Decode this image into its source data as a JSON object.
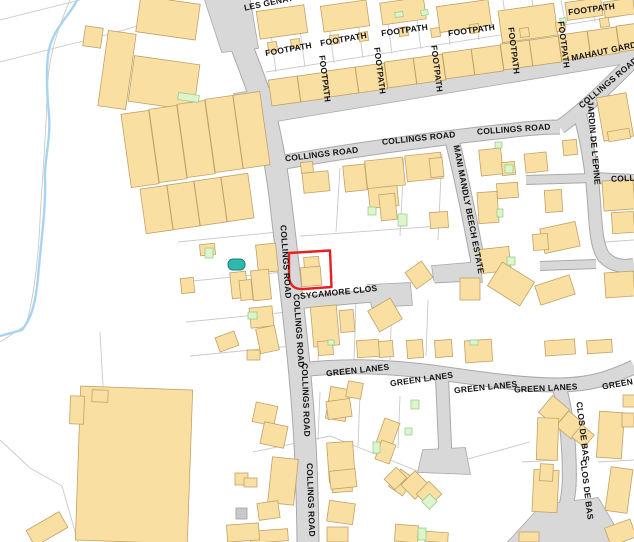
{
  "map": {
    "title": "Street map - Collings Road area",
    "colors": {
      "background": "#ffffff",
      "building_fill": "#FADFA3",
      "building_stroke": "#C0A267",
      "road_fill": "#D8D8D8",
      "road_casing": "#A9A9A9",
      "parcel_line": "#C9C9C9",
      "stream": "#A8D4F2",
      "green_fill": "#DCF5CC",
      "green_stroke": "#8FC985",
      "pool_fill": "#2FB9AE",
      "pool_stroke": "#17807A",
      "plot_outline": "#E62020",
      "label": "#141414",
      "gray_building_fill": "#C9C9C9",
      "gray_building_stroke": "#9E9E9E"
    },
    "labels": [
      {
        "t": "FOOTPATH",
        "x": 289,
        "y": 52,
        "r": -10
      },
      {
        "t": "FOOTPATH",
        "x": 344,
        "y": 42,
        "r": -10
      },
      {
        "t": "FOOTPATH",
        "x": 405,
        "y": 33,
        "r": -8
      },
      {
        "t": "FOOTPATH",
        "x": 472,
        "y": 33,
        "r": -8
      },
      {
        "t": "FOOTPATH",
        "x": 592,
        "y": 12,
        "r": -8
      },
      {
        "t": "FOOTPATH",
        "x": 322,
        "y": 79,
        "r": 83
      },
      {
        "t": "FOOTPATH",
        "x": 377,
        "y": 71,
        "r": 83
      },
      {
        "t": "FOOTPATH",
        "x": 434,
        "y": 69,
        "r": 83
      },
      {
        "t": "FOOTPATH",
        "x": 511,
        "y": 51,
        "r": 83
      },
      {
        "t": "FOOTPATH",
        "x": 561,
        "y": 45,
        "r": 83
      },
      {
        "t": "LES GENATS",
        "x": 272,
        "y": 5,
        "r": -12
      },
      {
        "t": "MAHAUT GARDENS",
        "x": 572,
        "y": 61,
        "r": -12,
        "a": "start"
      },
      {
        "t": "COLLINGS ROAD",
        "x": 610,
        "y": 85,
        "r": -40
      },
      {
        "t": "COLLINGS ROAD",
        "x": 322,
        "y": 157,
        "r": -7
      },
      {
        "t": "COLLINGS ROAD",
        "x": 419,
        "y": 141,
        "r": -6
      },
      {
        "t": "COLLINGS ROAD",
        "x": 514,
        "y": 132,
        "r": -4
      },
      {
        "t": "COLLINGS ROAD",
        "x": 648,
        "y": 180,
        "r": -3
      },
      {
        "t": "COLLINGS ROAD",
        "x": 283,
        "y": 262,
        "r": 86
      },
      {
        "t": "COLLINGS ROAD",
        "x": 296,
        "y": 331,
        "r": 86
      },
      {
        "t": "COLLINGS ROAD",
        "x": 303,
        "y": 400,
        "r": 88
      },
      {
        "t": "COLLINGS ROAD",
        "x": 308,
        "y": 500,
        "r": 88
      },
      {
        "t": "JARDIN DE L'EPINE",
        "x": 591,
        "y": 143,
        "r": 85
      },
      {
        "t": "MANI MANDLY BEECH ESTATE",
        "x": 466,
        "y": 210,
        "r": 79
      },
      {
        "t": "SYCAMORE CLOS",
        "x": 339,
        "y": 295,
        "r": -6
      },
      {
        "t": "GREEN LANES",
        "x": 358,
        "y": 373,
        "r": -6
      },
      {
        "t": "GREEN LANES",
        "x": 422,
        "y": 382,
        "r": -8
      },
      {
        "t": "GREEN LANES",
        "x": 486,
        "y": 390,
        "r": -6
      },
      {
        "t": "GREEN LANES",
        "x": 546,
        "y": 391,
        "r": -3
      },
      {
        "t": "GREEN LANES",
        "x": 634,
        "y": 384,
        "r": -10
      },
      {
        "t": "CLOS DE BAS",
        "x": 580,
        "y": 432,
        "r": 83
      },
      {
        "t": "CLOS DE BAS",
        "x": 584,
        "y": 490,
        "r": 83
      }
    ],
    "roads": [
      {
        "name": "collings-road-vertical",
        "d": "M226,0 C238,42 254,74 263,106 C272,140 277,170 281,205 C287,255 293,305 298,355 C303,405 307,455 308,542",
        "w": 21
      },
      {
        "name": "collings-road-horizontal",
        "d": "M274,164 C340,152 430,139 506,131 C530,128 546,127 560,127",
        "w": 13
      },
      {
        "name": "collings-road-diagonal",
        "d": "M560,127 C582,111 604,90 632,62",
        "w": 13
      },
      {
        "name": "jardin-de-lepine",
        "d": "M578,108 C588,142 592,172 594,202 C596,232 597,247 604,257 C613,266 623,267 634,265",
        "w": 12
      },
      {
        "name": "collings-road-east-spur",
        "d": "M594,178 L634,180",
        "w": 10
      },
      {
        "name": "stub-west",
        "d": "M526,180 L594,178",
        "w": 8
      },
      {
        "name": "stub-265",
        "d": "M540,266 L596,264",
        "w": 8
      },
      {
        "name": "mani-mandly-beech-estate",
        "d": "M452,140 C462,180 469,215 476,252 C479,264 478,272 470,274 L434,276",
        "w": 13
      },
      {
        "name": "sycamore-clos",
        "d": "M294,303 L372,296",
        "w": 11
      },
      {
        "name": "green-lanes",
        "d": "M300,370 C345,365 385,366 432,372 C482,379 522,385 558,385 C592,385 612,377 634,367",
        "w": 13
      },
      {
        "name": "green-lanes-branch",
        "d": "M442,378 C443,402 444,424 445,446 L445,460",
        "w": 12
      },
      {
        "name": "clos-de-bas",
        "d": "M560,390 C566,412 568,434 569,458 C570,484 569,498 564,512 C558,528 548,536 538,542",
        "w": 13
      }
    ],
    "road_polygons": [
      {
        "name": "mahaut-gardens-road",
        "pts": "234,94 634,24 634,62 240,127"
      },
      {
        "name": "sycamore-bulb",
        "pts": "368,285 410,283 412,305 372,307"
      },
      {
        "name": "mani-flare",
        "pts": "432,266 480,262 482,282 434,280"
      },
      {
        "name": "branch-flare",
        "pts": "423,450 465,448 470,474 418,472"
      },
      {
        "name": "clos-flare",
        "pts": "542,505 598,498 624,542 508,542"
      },
      {
        "name": "road-top-corner",
        "pts": "205,0 250,0 258,48 222,52"
      }
    ],
    "buildings": [
      [
        138,
        0,
        60,
        36,
        8
      ],
      [
        103,
        32,
        28,
        76,
        8
      ],
      [
        131,
        60,
        66,
        46,
        8
      ],
      [
        84,
        27,
        18,
        20,
        8
      ],
      [
        126,
        112,
        28,
        74,
        -8
      ],
      [
        154,
        107,
        28,
        74,
        -8
      ],
      [
        182,
        102,
        28,
        74,
        -8
      ],
      [
        210,
        97,
        28,
        74,
        -8
      ],
      [
        238,
        93,
        27,
        74,
        -8
      ],
      [
        143,
        187,
        27,
        45,
        -8
      ],
      [
        170,
        183,
        27,
        45,
        -8
      ],
      [
        197,
        179,
        27,
        45,
        -8
      ],
      [
        224,
        175,
        27,
        45,
        -8
      ],
      [
        258,
        8,
        48,
        28,
        -8
      ],
      [
        322,
        3,
        46,
        26,
        -8
      ],
      [
        381,
        0,
        44,
        22,
        -8
      ],
      [
        438,
        3,
        52,
        26,
        -8
      ],
      [
        500,
        7,
        56,
        32,
        -8
      ],
      [
        566,
        0,
        36,
        18,
        -8
      ],
      [
        604,
        0,
        30,
        16,
        -8
      ],
      [
        268,
        42,
        9,
        9,
        -8
      ],
      [
        291,
        39,
        9,
        9,
        -8
      ],
      [
        330,
        35,
        9,
        9,
        -8
      ],
      [
        359,
        32,
        9,
        9,
        -8
      ],
      [
        399,
        27,
        9,
        9,
        -8
      ],
      [
        431,
        28,
        9,
        9,
        -8
      ],
      [
        470,
        24,
        9,
        9,
        -8
      ],
      [
        520,
        28,
        9,
        9,
        -8
      ],
      [
        556,
        22,
        9,
        9,
        -8
      ],
      [
        600,
        18,
        9,
        9,
        -8
      ],
      [
        270,
        78,
        29,
        26,
        -8
      ],
      [
        299,
        74,
        29,
        26,
        -8
      ],
      [
        328,
        69,
        29,
        26,
        -8
      ],
      [
        357,
        65,
        29,
        26,
        -8
      ],
      [
        386,
        60,
        29,
        26,
        -8
      ],
      [
        415,
        56,
        29,
        26,
        -8
      ],
      [
        444,
        51,
        29,
        26,
        -8
      ],
      [
        473,
        47,
        29,
        26,
        -8
      ],
      [
        502,
        42,
        29,
        26,
        -8
      ],
      [
        531,
        38,
        29,
        26,
        -8
      ],
      [
        560,
        33,
        29,
        26,
        -8
      ],
      [
        589,
        29,
        29,
        26,
        -8
      ],
      [
        618,
        24,
        29,
        26,
        -8
      ],
      [
        301,
        162,
        12,
        11,
        -6
      ],
      [
        303,
        172,
        26,
        20,
        -6
      ],
      [
        344,
        165,
        22,
        26,
        -6
      ],
      [
        366,
        159,
        38,
        28,
        -6
      ],
      [
        406,
        154,
        36,
        26,
        -6
      ],
      [
        369,
        187,
        29,
        20,
        -6
      ],
      [
        380,
        194,
        16,
        26,
        -6
      ],
      [
        430,
        158,
        13,
        19,
        -6
      ],
      [
        480,
        149,
        22,
        26,
        -6
      ],
      [
        502,
        162,
        13,
        13,
        -6
      ],
      [
        525,
        153,
        22,
        19,
        -6
      ],
      [
        563,
        140,
        14,
        15,
        -6
      ],
      [
        600,
        95,
        30,
        44,
        -10
      ],
      [
        608,
        130,
        22,
        10,
        -10
      ],
      [
        497,
        183,
        21,
        15,
        -4
      ],
      [
        478,
        192,
        20,
        31,
        -4
      ],
      [
        430,
        212,
        18,
        16,
        -4
      ],
      [
        545,
        190,
        17,
        22,
        -4
      ],
      [
        542,
        225,
        36,
        25,
        -12
      ],
      [
        603,
        180,
        31,
        30,
        -4
      ],
      [
        612,
        212,
        22,
        21,
        -4
      ],
      [
        480,
        248,
        30,
        24,
        -6
      ],
      [
        533,
        234,
        15,
        16,
        -4
      ],
      [
        537,
        280,
        36,
        20,
        -18
      ],
      [
        605,
        272,
        29,
        25,
        -4
      ],
      [
        492,
        270,
        38,
        28,
        32
      ],
      [
        460,
        278,
        20,
        22,
        0
      ],
      [
        304,
        257,
        15,
        11,
        -5
      ],
      [
        301,
        267,
        20,
        19,
        -5
      ],
      [
        257,
        244,
        20,
        28,
        -6
      ],
      [
        200,
        244,
        15,
        11,
        -6
      ],
      [
        181,
        278,
        13,
        15,
        -6
      ],
      [
        231,
        272,
        16,
        26,
        -6
      ],
      [
        252,
        270,
        18,
        30,
        -6
      ],
      [
        240,
        280,
        12,
        20,
        -6
      ],
      [
        250,
        307,
        23,
        20,
        -6
      ],
      [
        258,
        327,
        19,
        25,
        -12
      ],
      [
        312,
        306,
        26,
        40,
        -5
      ],
      [
        340,
        310,
        14,
        22,
        -5
      ],
      [
        372,
        303,
        26,
        24,
        -30
      ],
      [
        409,
        265,
        20,
        20,
        -35
      ],
      [
        318,
        341,
        15,
        14,
        -4
      ],
      [
        357,
        340,
        22,
        17,
        -4
      ],
      [
        379,
        341,
        14,
        16,
        -4
      ],
      [
        407,
        340,
        16,
        18,
        -4
      ],
      [
        435,
        340,
        17,
        17,
        -4
      ],
      [
        465,
        340,
        27,
        22,
        -4
      ],
      [
        545,
        340,
        30,
        15,
        -4
      ],
      [
        587,
        340,
        25,
        13,
        -4
      ],
      [
        328,
        388,
        20,
        32,
        10
      ],
      [
        347,
        382,
        15,
        16,
        10
      ],
      [
        254,
        404,
        22,
        20,
        12
      ],
      [
        262,
        424,
        24,
        22,
        12
      ],
      [
        270,
        458,
        26,
        46,
        6
      ],
      [
        235,
        473,
        13,
        12,
        0
      ],
      [
        258,
        502,
        21,
        17,
        -8
      ],
      [
        250,
        530,
        38,
        12,
        -4
      ],
      [
        327,
        400,
        24,
        18,
        -8
      ],
      [
        328,
        442,
        26,
        40,
        -4
      ],
      [
        332,
        480,
        20,
        12,
        -4
      ],
      [
        380,
        420,
        16,
        26,
        20
      ],
      [
        378,
        442,
        15,
        20,
        20
      ],
      [
        393,
        472,
        17,
        21,
        35
      ],
      [
        330,
        470,
        26,
        18,
        -6
      ],
      [
        328,
        502,
        26,
        21,
        8
      ],
      [
        327,
        527,
        21,
        15,
        0
      ],
      [
        395,
        525,
        23,
        17,
        4
      ],
      [
        425,
        532,
        23,
        10,
        4
      ],
      [
        388,
        470,
        15,
        17,
        45
      ],
      [
        405,
        475,
        20,
        20,
        45
      ],
      [
        420,
        485,
        18,
        18,
        45
      ],
      [
        543,
        400,
        22,
        22,
        40
      ],
      [
        560,
        415,
        20,
        20,
        40
      ],
      [
        575,
        428,
        16,
        16,
        40
      ],
      [
        537,
        418,
        21,
        42,
        2
      ],
      [
        533,
        470,
        25,
        42,
        3
      ],
      [
        540,
        464,
        13,
        17,
        3
      ],
      [
        598,
        412,
        25,
        46,
        4
      ],
      [
        608,
        468,
        22,
        44,
        8
      ],
      [
        622,
        413,
        12,
        14,
        0
      ],
      [
        623,
        395,
        12,
        12,
        0
      ],
      [
        607,
        523,
        27,
        19,
        -20
      ],
      [
        519,
        532,
        20,
        10,
        0
      ],
      [
        78,
        388,
        112,
        154,
        2
      ],
      [
        70,
        396,
        14,
        28,
        2
      ],
      [
        92,
        390,
        16,
        12,
        2
      ],
      [
        28,
        520,
        38,
        18,
        -30
      ],
      [
        217,
        334,
        20,
        15,
        -20
      ],
      [
        247,
        350,
        13,
        10,
        0
      ],
      [
        244,
        478,
        13,
        9,
        0
      ],
      [
        227,
        524,
        32,
        17,
        -4
      ]
    ],
    "green_patches": [
      [
        178,
        94,
        21,
        7,
        8
      ],
      [
        395,
        12,
        8,
        5,
        -8
      ],
      [
        421,
        10,
        7,
        5,
        -8
      ],
      [
        560,
        18,
        6,
        5,
        -8
      ],
      [
        495,
        142,
        7,
        6,
        0
      ],
      [
        505,
        165,
        8,
        8,
        0
      ],
      [
        497,
        209,
        6,
        8,
        0
      ],
      [
        507,
        257,
        8,
        8,
        0
      ],
      [
        398,
        214,
        9,
        12,
        0
      ],
      [
        368,
        207,
        8,
        8,
        0
      ],
      [
        205,
        248,
        8,
        10,
        0
      ],
      [
        248,
        312,
        9,
        7,
        0
      ],
      [
        328,
        340,
        6,
        5,
        0
      ],
      [
        470,
        340,
        8,
        5,
        0
      ],
      [
        373,
        442,
        7,
        11,
        0
      ],
      [
        405,
        428,
        7,
        7,
        0
      ],
      [
        411,
        400,
        8,
        9,
        0
      ],
      [
        424,
        496,
        11,
        11,
        45
      ],
      [
        418,
        528,
        8,
        12,
        0
      ]
    ],
    "gray_buildings": [
      [
        236,
        508,
        11,
        11
      ]
    ],
    "pool": {
      "x": 228,
      "y": 259,
      "w": 17,
      "h": 11,
      "rx": 5
    },
    "stream": {
      "d": "M77,0 C70,16 52,28 48,55 C46,75 47,95 49,115 C51,140 44,160 45,180 C46,210 41,240 38,278 C35,308 30,320 22,330 L0,336"
    },
    "parcels": [
      "M0,20 L80,0",
      "M0,62 L95,38 L152,22",
      "M70,0 C55,35 48,60 47,95 C46,140 42,180 40,220 C38,265 33,300 26,325 L0,342",
      "M0,440 L30,468 L62,486 L78,542",
      "M100,332 L106,440 L190,458",
      "M266,72 L620,16",
      "M276,72 L271,34",
      "M305,67 L300,30",
      "M334,63 L329,25",
      "M363,58 L358,21",
      "M392,54 L387,16",
      "M421,49 L416,12",
      "M450,45 L445,7",
      "M479,40 L474,3",
      "M508,36 L503,0",
      "M537,31 L532,0",
      "M566,27 L561,0",
      "M595,22 L590,0",
      "M340,168 L336,232",
      "M404,158 L400,236",
      "M442,154 L438,240",
      "M300,236 L440,226",
      "M178,242 L278,232",
      "M182,282 L284,272",
      "M186,322 L288,312",
      "M190,356 L292,346",
      "M320,302 L318,362",
      "M356,300 L354,362",
      "M392,298 L390,360",
      "M428,300 L426,356",
      "M253,452 L330,436 L420,472 L530,442",
      "M320,392 L318,440",
      "M360,394 L358,446",
      "M400,396 L398,448",
      "M522,462 L558,460",
      "M598,462 L634,460",
      "M604,242 L634,240"
    ],
    "red_plot": {
      "d": "M289,253 L330,250.5 L331.5,287 L304,289 Q289.5,290 289,276 Z"
    }
  }
}
